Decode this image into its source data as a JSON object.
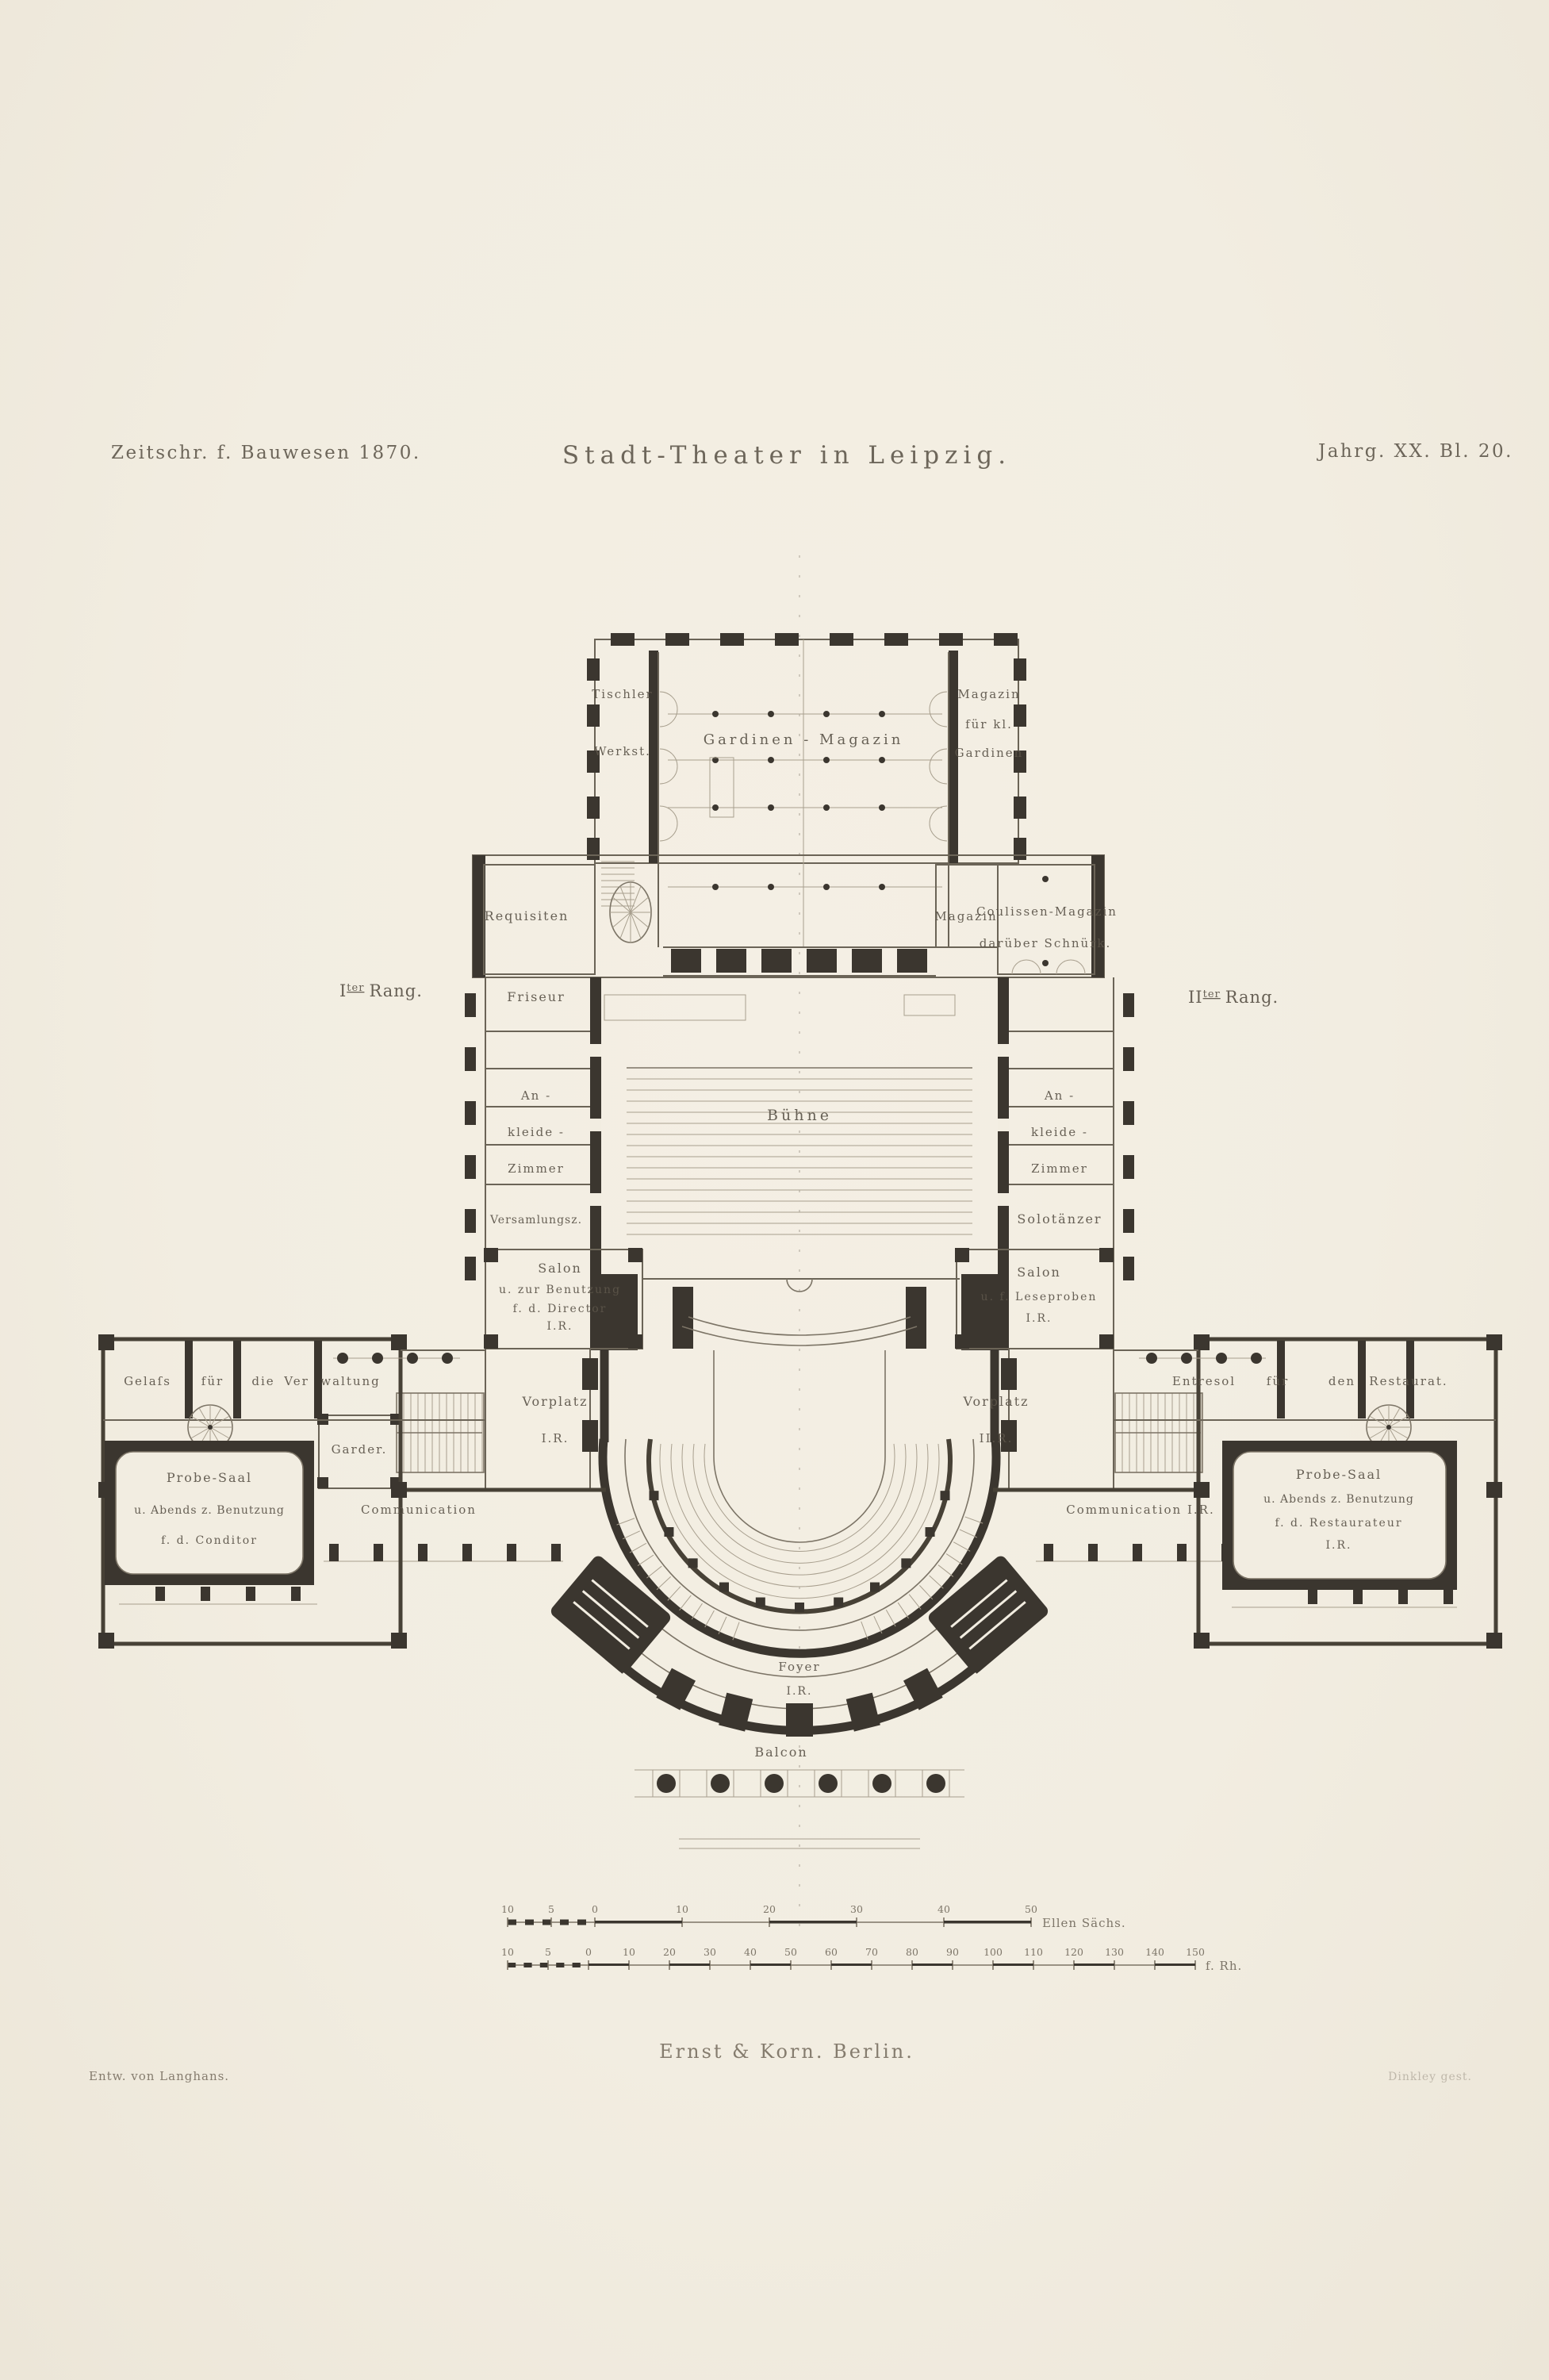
{
  "header": {
    "left": "Zeitschr. f. Bauwesen 1870.",
    "title": "Stadt-Theater in Leipzig.",
    "right": "Jahrg. XX. Bl. 20."
  },
  "rang": {
    "left": {
      "numeral": "I",
      "sup": "ter",
      "word": "Rang."
    },
    "right": {
      "numeral": "II",
      "sup": "ter",
      "word": "Rang."
    }
  },
  "rooms": {
    "tischler": {
      "l1": "Tischler",
      "l2": "Werkst."
    },
    "gardinen": "Gardinen - Magazin",
    "magkl": {
      "l1": "Magazin",
      "l2": "für kl.",
      "l3": "Gardinen"
    },
    "requisiten": "Requisiten",
    "magazin": "Magazin",
    "coulissen": {
      "l1": "Coulissen-Magazin",
      "l2": "darüber Schnürk."
    },
    "friseur": "Friseur",
    "buehne": "Bühne",
    "an_l": "An -",
    "kleide_l": "kleide -",
    "zimmer_l": "Zimmer",
    "versammlung": "Versamlungsz.",
    "an_r": "An -",
    "kleide_r": "kleide -",
    "zimmer_r": "Zimmer",
    "solo": "Solotänzer",
    "salon_dir": {
      "l1": "Salon",
      "l2": "u. zur Benutzung",
      "l3": "f. d. Director",
      "l4": "I.R."
    },
    "salon_lese": {
      "l1": "Salon",
      "l2": "u. f. Leseproben",
      "l3": "I.R."
    },
    "vorplatz_l": {
      "l1": "Vorplatz",
      "l2": "I.R."
    },
    "vorplatz_r": {
      "l1": "Vorplatz",
      "l2": "II.R."
    },
    "gelass": {
      "w1": "Gelaſs",
      "w2": "für",
      "w3": "die",
      "w4": "Ver",
      "w5": "waltung"
    },
    "garder": "Garder.",
    "probe_l": {
      "l1": "Probe-Saal",
      "l2": "u. Abends z. Benutzung",
      "l3": "f. d. Conditor"
    },
    "comm_l": "Communication",
    "entresol": {
      "w1": "Entresol",
      "w2": "für",
      "w3": "den",
      "w4": "Restaurat."
    },
    "probe_r": {
      "l1": "Probe-Saal",
      "l2": "u. Abends z. Benutzung",
      "l3": "f. d. Restaurateur",
      "l4": "I.R."
    },
    "comm_r": "Communication I.R.",
    "foyer": {
      "l1": "Foyer",
      "l2": "I.R."
    },
    "balcon": "Balcon"
  },
  "scale": {
    "ellen": {
      "marks": [
        "10",
        "5",
        "0",
        "10",
        "20",
        "30",
        "40",
        "50"
      ],
      "unit": "Ellen Sächs."
    },
    "fuss": {
      "marks": [
        "10",
        "5",
        "0",
        "10",
        "20",
        "30",
        "40",
        "50",
        "60",
        "70",
        "80",
        "90",
        "100",
        "110",
        "120",
        "130",
        "140",
        "150"
      ],
      "unit": "f. Rh."
    }
  },
  "footer": {
    "publisher": "Ernst & Korn. Berlin.",
    "designer": "Entw. von Langhans.",
    "engraver": "Dinkley gest."
  },
  "colors": {
    "paper": "#f2ede1",
    "ink": "#3b362f",
    "label": "#5c554a"
  }
}
